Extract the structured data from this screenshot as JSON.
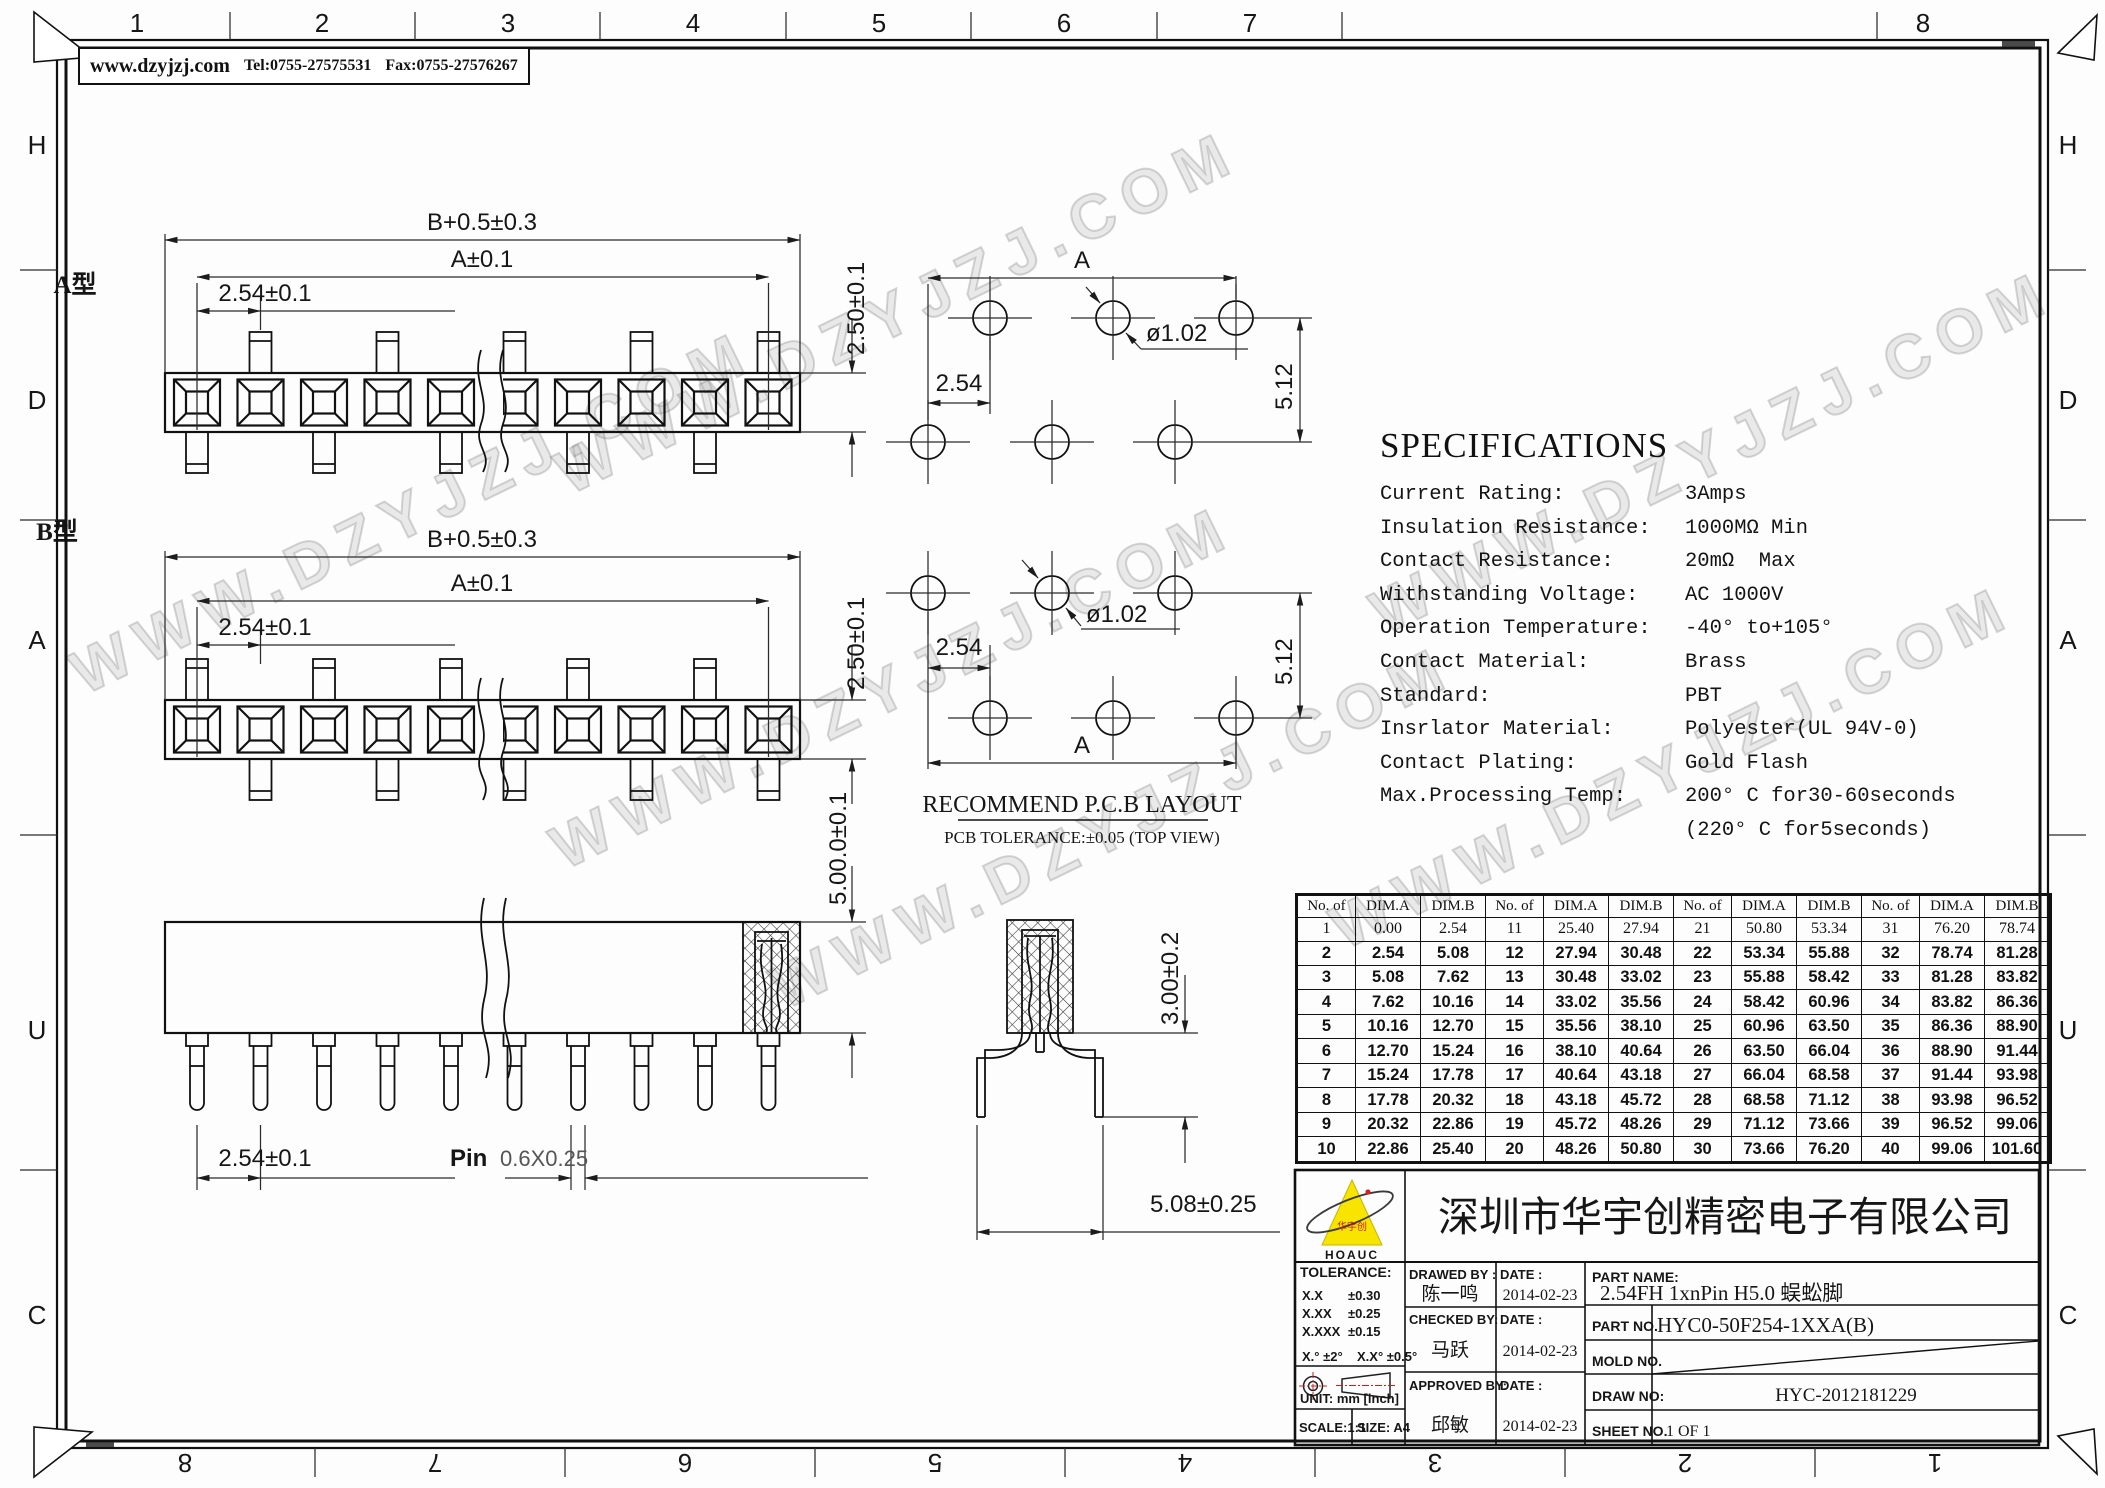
{
  "header": {
    "website": "www.dzyjzj.com",
    "tel": "Tel:0755-27575531",
    "fax": "Fax:0755-27576267"
  },
  "watermark": {
    "text": "WWW.DZYJZJ.COM"
  },
  "border": {
    "top_numbers": [
      "1",
      "2",
      "3",
      "4",
      "5",
      "6",
      "7",
      "8"
    ],
    "bottom_numbers": [
      "8",
      "7",
      "6",
      "5",
      "4",
      "3",
      "2",
      "1"
    ],
    "side_letters": [
      "H",
      "D",
      "A",
      "U",
      "C"
    ]
  },
  "views": {
    "type_a_label": "A型",
    "type_b_label": "B型",
    "dim_overall": "B+0.5±0.3",
    "dim_a": "A±0.1",
    "dim_pitch": "2.54±0.1",
    "dim_body_height": "2.50±0.1",
    "dim_total_height": "5.00.0±0.1",
    "pin_label": "Pin",
    "pin_size": "0.6X0.25",
    "dim_section_depth": "3.00±0.2",
    "dim_section_span": "5.08±0.25"
  },
  "pcb": {
    "title": "RECOMMEND P.C.B LAYOUT",
    "subtitle": "PCB TOLERANCE:±0.05 (TOP VIEW)",
    "dim_a": "A",
    "dim_pitch": "2.54",
    "dim_hole": "ø1.02",
    "dim_row_gap": "5.12"
  },
  "specifications": {
    "title": "SPECIFICATIONS",
    "rows": [
      {
        "label": "Current Rating:",
        "value": "3Amps"
      },
      {
        "label": "Insulation Resistance:",
        "value": "1000MΩ Min"
      },
      {
        "label": "Contact Resistance:",
        "value": "20mΩ  Max"
      },
      {
        "label": "Withstanding Voltage:",
        "value": "AC 1000V"
      },
      {
        "label": "Operation Temperature:",
        "value": "-40° to+105°"
      },
      {
        "label": "Contact Material:",
        "value": "Brass"
      },
      {
        "label": "Standard:",
        "value": "PBT"
      },
      {
        "label": "Insrlator Material:",
        "value": "Polyester(UL 94V-0)"
      },
      {
        "label": "Contact Plating:",
        "value": "Gold Flash"
      },
      {
        "label": "Max.Processing Temp:",
        "value": "200° C for30-60seconds"
      },
      {
        "label": "",
        "value": "(220° C for5seconds)"
      }
    ]
  },
  "dim_table": {
    "headers": [
      "No. of",
      "DIM.A",
      "DIM.B"
    ],
    "groups": [
      [
        [
          "1",
          "0.00",
          "2.54"
        ],
        [
          "2",
          "2.54",
          "5.08"
        ],
        [
          "3",
          "5.08",
          "7.62"
        ],
        [
          "4",
          "7.62",
          "10.16"
        ],
        [
          "5",
          "10.16",
          "12.70"
        ],
        [
          "6",
          "12.70",
          "15.24"
        ],
        [
          "7",
          "15.24",
          "17.78"
        ],
        [
          "8",
          "17.78",
          "20.32"
        ],
        [
          "9",
          "20.32",
          "22.86"
        ],
        [
          "10",
          "22.86",
          "25.40"
        ]
      ],
      [
        [
          "11",
          "25.40",
          "27.94"
        ],
        [
          "12",
          "27.94",
          "30.48"
        ],
        [
          "13",
          "30.48",
          "33.02"
        ],
        [
          "14",
          "33.02",
          "35.56"
        ],
        [
          "15",
          "35.56",
          "38.10"
        ],
        [
          "16",
          "38.10",
          "40.64"
        ],
        [
          "17",
          "40.64",
          "43.18"
        ],
        [
          "18",
          "43.18",
          "45.72"
        ],
        [
          "19",
          "45.72",
          "48.26"
        ],
        [
          "20",
          "48.26",
          "50.80"
        ]
      ],
      [
        [
          "21",
          "50.80",
          "53.34"
        ],
        [
          "22",
          "53.34",
          "55.88"
        ],
        [
          "23",
          "55.88",
          "58.42"
        ],
        [
          "24",
          "58.42",
          "60.96"
        ],
        [
          "25",
          "60.96",
          "63.50"
        ],
        [
          "26",
          "63.50",
          "66.04"
        ],
        [
          "27",
          "66.04",
          "68.58"
        ],
        [
          "28",
          "68.58",
          "71.12"
        ],
        [
          "29",
          "71.12",
          "73.66"
        ],
        [
          "30",
          "73.66",
          "76.20"
        ]
      ],
      [
        [
          "31",
          "76.20",
          "78.74"
        ],
        [
          "32",
          "78.74",
          "81.28"
        ],
        [
          "33",
          "81.28",
          "83.82"
        ],
        [
          "34",
          "83.82",
          "86.36"
        ],
        [
          "35",
          "86.36",
          "88.90"
        ],
        [
          "36",
          "88.90",
          "91.44"
        ],
        [
          "37",
          "91.44",
          "93.98"
        ],
        [
          "38",
          "93.98",
          "96.52"
        ],
        [
          "39",
          "96.52",
          "99.06"
        ],
        [
          "40",
          "99.06",
          "101.60"
        ]
      ]
    ]
  },
  "title_block": {
    "logo": {
      "brand": "HOAUC",
      "cn": "华宇创"
    },
    "company": "深圳市华宇创精密电子有限公司",
    "tolerance": {
      "title": "TOLERANCE:",
      "l1a": "X.X",
      "l1b": "±0.30",
      "l2a": "X.XX",
      "l2b": "±0.25",
      "l3a": "X.XXX",
      "l3b": "±0.15",
      "a1": "X.°  ±2°",
      "a2": "X.X° ±0.5°"
    },
    "unit": "UNIT:  mm  [inch]",
    "scale": "SCALE:1:1",
    "size": "SIZE:  A4",
    "rows": [
      {
        "by_label": "DRAWED BY :",
        "by": "陈一鸣",
        "date_label": "DATE :",
        "date": "2014-02-23"
      },
      {
        "by_label": "CHECKED BY:",
        "by": "马跃",
        "date_label": "DATE :",
        "date": "2014-02-23"
      },
      {
        "by_label": "APPROVED BY:",
        "by": "邱敏",
        "date_label": "DATE :",
        "date": "2014-02-23"
      }
    ],
    "part_name_label": "PART NAME:",
    "part_name": "2.54FH 1xnPin H5.0 蜈蚣脚",
    "part_no_label": "PART NO.",
    "part_no": "HYC0-50F254-1XXA(B)",
    "mold_no_label": "MOLD NO.",
    "draw_no_label": "DRAW NO:",
    "draw_no": "HYC-2012181229",
    "sheet_no_label": "SHEET NO.",
    "sheet_no": "1 OF 1"
  }
}
